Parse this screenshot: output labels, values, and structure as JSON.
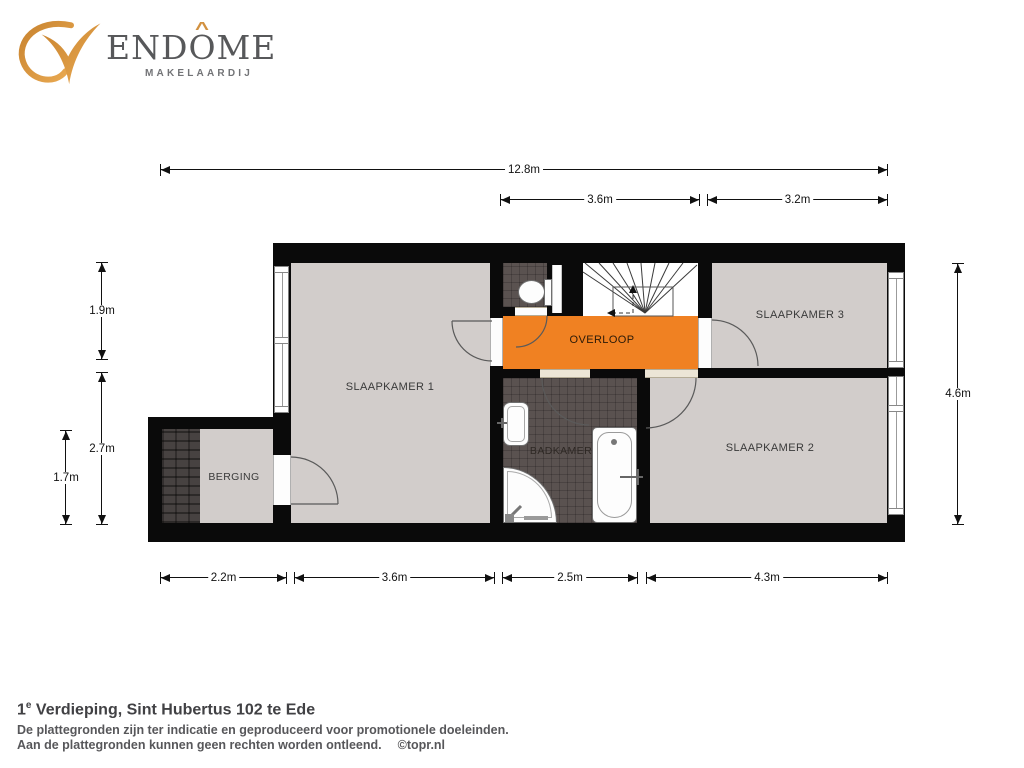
{
  "brand": {
    "v_initial": "V",
    "name_pre": "END",
    "name_o": "O",
    "accent": "^",
    "name_post": "ME",
    "subtitle": "MAKELAARDIJ"
  },
  "rooms": {
    "slaapkamer1": "SLAAPKAMER 1",
    "slaapkamer2": "SLAAPKAMER 2",
    "slaapkamer3": "SLAAPKAMER 3",
    "overloop": "OVERLOOP",
    "badkamer": "BADKAMER",
    "berging": "BERGING"
  },
  "dimensions": {
    "total_width": "12.8m",
    "overloop_width": "3.6m",
    "slaapkamer3_width": "3.2m",
    "left_upper_height": "1.9m",
    "left_lower_height": "2.7m",
    "berging_height": "1.7m",
    "right_height": "4.6m",
    "berging_width": "2.2m",
    "slaapkamer1_width": "3.6m",
    "badkamer_width": "2.5m",
    "slaapkamer2_width": "4.3m"
  },
  "footer": {
    "title_num": "1",
    "title_sup": "e",
    "title_rest": " Verdieping, Sint Hubertus 102 te Ede",
    "disclaimer1": "De plattegronden zijn ter indicatie en geproduceerd voor promotionele doeleinden.",
    "disclaimer2": "Aan de plattegronden kunnen geen rechten worden ontleend.",
    "credit": "©topr.nl"
  },
  "colors": {
    "accent_orange": "#f08122",
    "wall_black": "#0a0a0a",
    "floor_gray": "#d2cdcb",
    "tile_dark": "#5a5250",
    "logo_gold": "#d29140",
    "brand_gray": "#57585a"
  }
}
